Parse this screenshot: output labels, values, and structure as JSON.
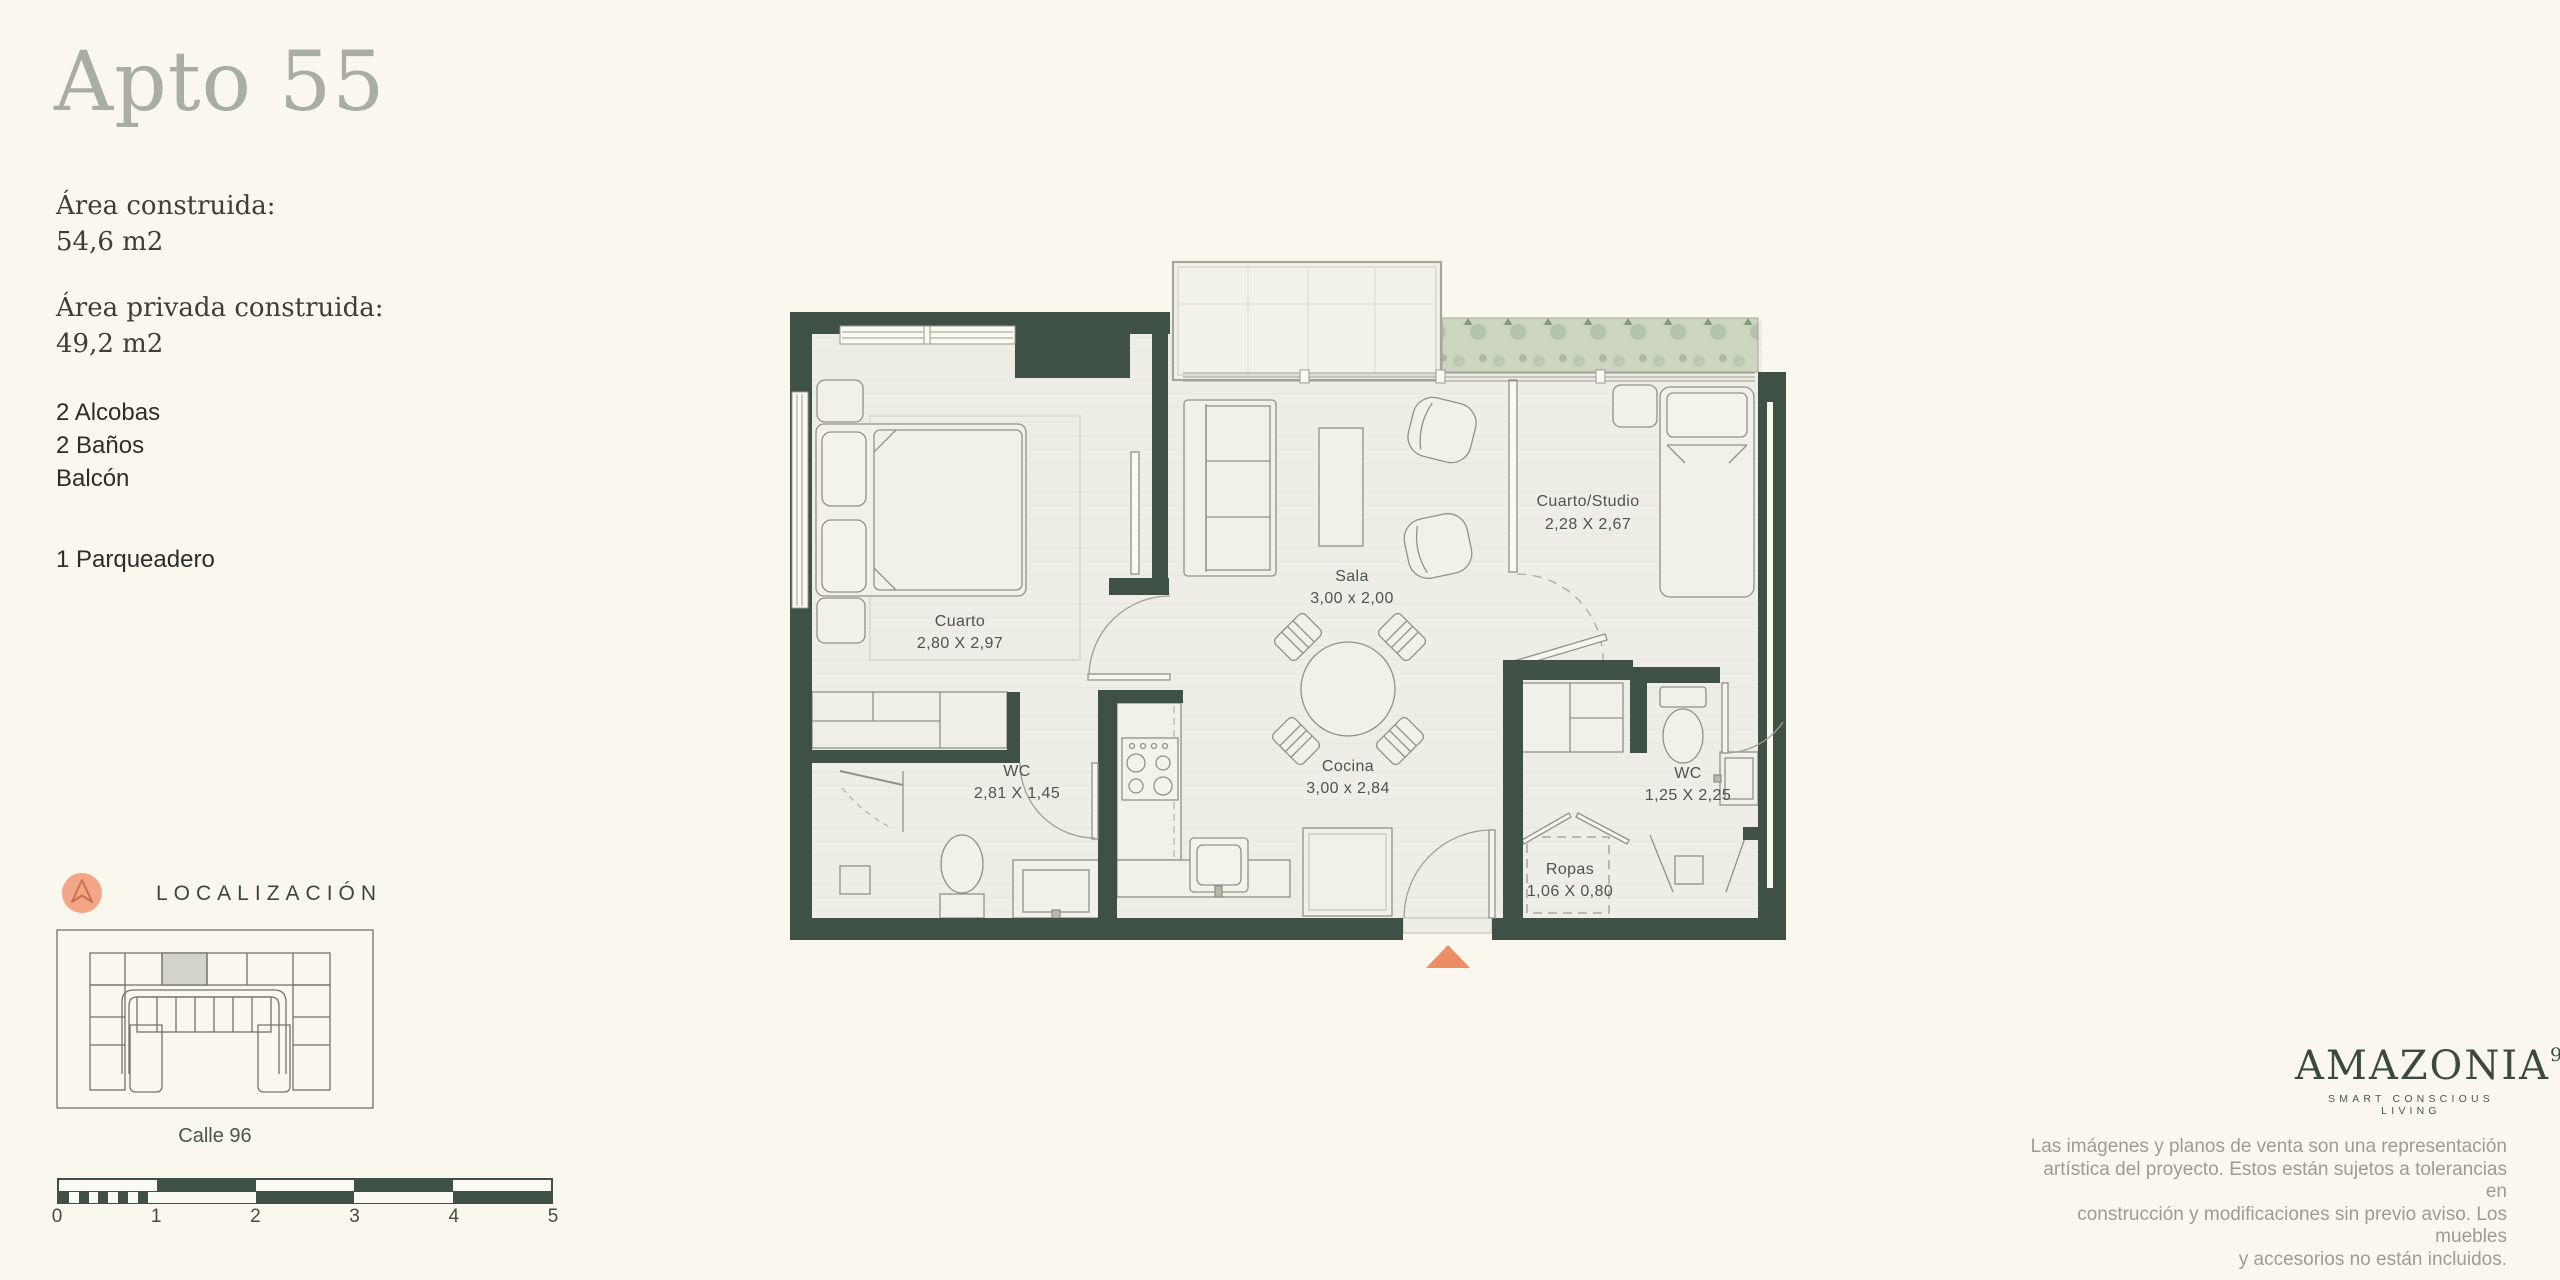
{
  "title": "Apto 55",
  "areas": {
    "built": {
      "label": "Área construida:",
      "value": "54,6 m2"
    },
    "private": {
      "label": "Área privada construida:",
      "value": "49,2 m2"
    }
  },
  "features": {
    "alcobas": "2 Alcobas",
    "banos": "2 Baños",
    "balcon": "Balcón",
    "parqueadero": "1 Parqueadero"
  },
  "localization": {
    "heading": "LOCALIZACIÓN",
    "street": "Calle 96"
  },
  "scalebar": {
    "ticks": [
      "0",
      "1",
      "2",
      "3",
      "4",
      "5"
    ]
  },
  "floorplan": {
    "rooms": [
      {
        "name": "Cuarto",
        "dims": "2,80 X 2,97"
      },
      {
        "name": "Sala",
        "dims": "3,00 x 2,00"
      },
      {
        "name": "Cuarto/Studio",
        "dims": "2,28 X 2,67"
      },
      {
        "name": "WC",
        "dims": "2,81 X 1,45"
      },
      {
        "name": "Cocina",
        "dims": "3,00 x 2,84"
      },
      {
        "name": "WC",
        "dims": "1,25 X 2,25"
      },
      {
        "name": "Ropas",
        "dims": "1,06 X 0,80"
      }
    ]
  },
  "brand": {
    "name": "AMAZONIA",
    "superscript": "96",
    "tagline": "SMART CONSCIOUS LIVING"
  },
  "disclaimer": {
    "lines": [
      "Las imágenes y planos de venta son una representación",
      "artística del proyecto. Estos están sujetos a tolerancias en",
      "construcción y modificaciones sin previo aviso. Los muebles",
      "y accesorios no están incluidos."
    ]
  },
  "colors": {
    "background": "#faf8ee",
    "wall_green": "#3e5144",
    "accent_orange": "#ec8d66",
    "compass_salmon": "#f3a587",
    "title_gray": "#a8aea2",
    "brand_green": "#3c4a3e",
    "planter_green": "#cbd5bf"
  }
}
